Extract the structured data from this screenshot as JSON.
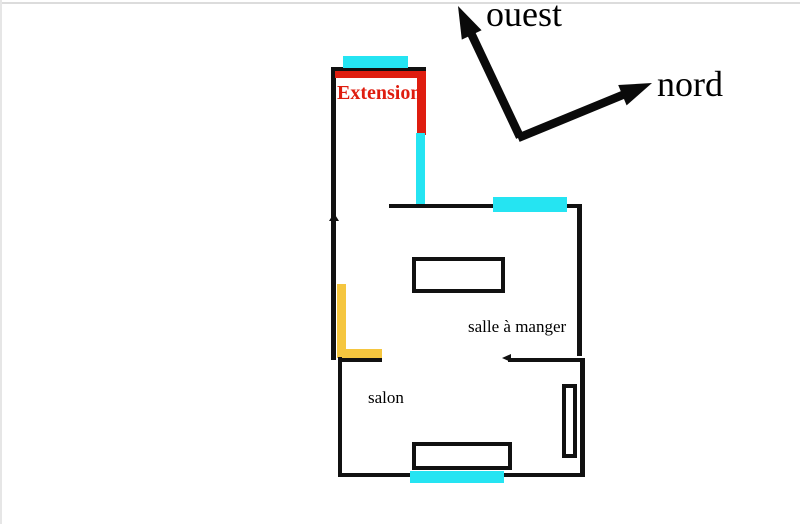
{
  "compass": {
    "west_label": "ouest",
    "north_label": "nord"
  },
  "rooms": {
    "extension": {
      "label": "Extension"
    },
    "dining_room": {
      "label": "salle à manger"
    },
    "living_room": {
      "label": "salon"
    }
  },
  "colors": {
    "background": "#ffffff",
    "wall": "#111111",
    "window_cyan": "#25e4f2",
    "extension_red": "#df1d0f",
    "accent_yellow": "#f5c63f",
    "label_text": "#000000"
  }
}
